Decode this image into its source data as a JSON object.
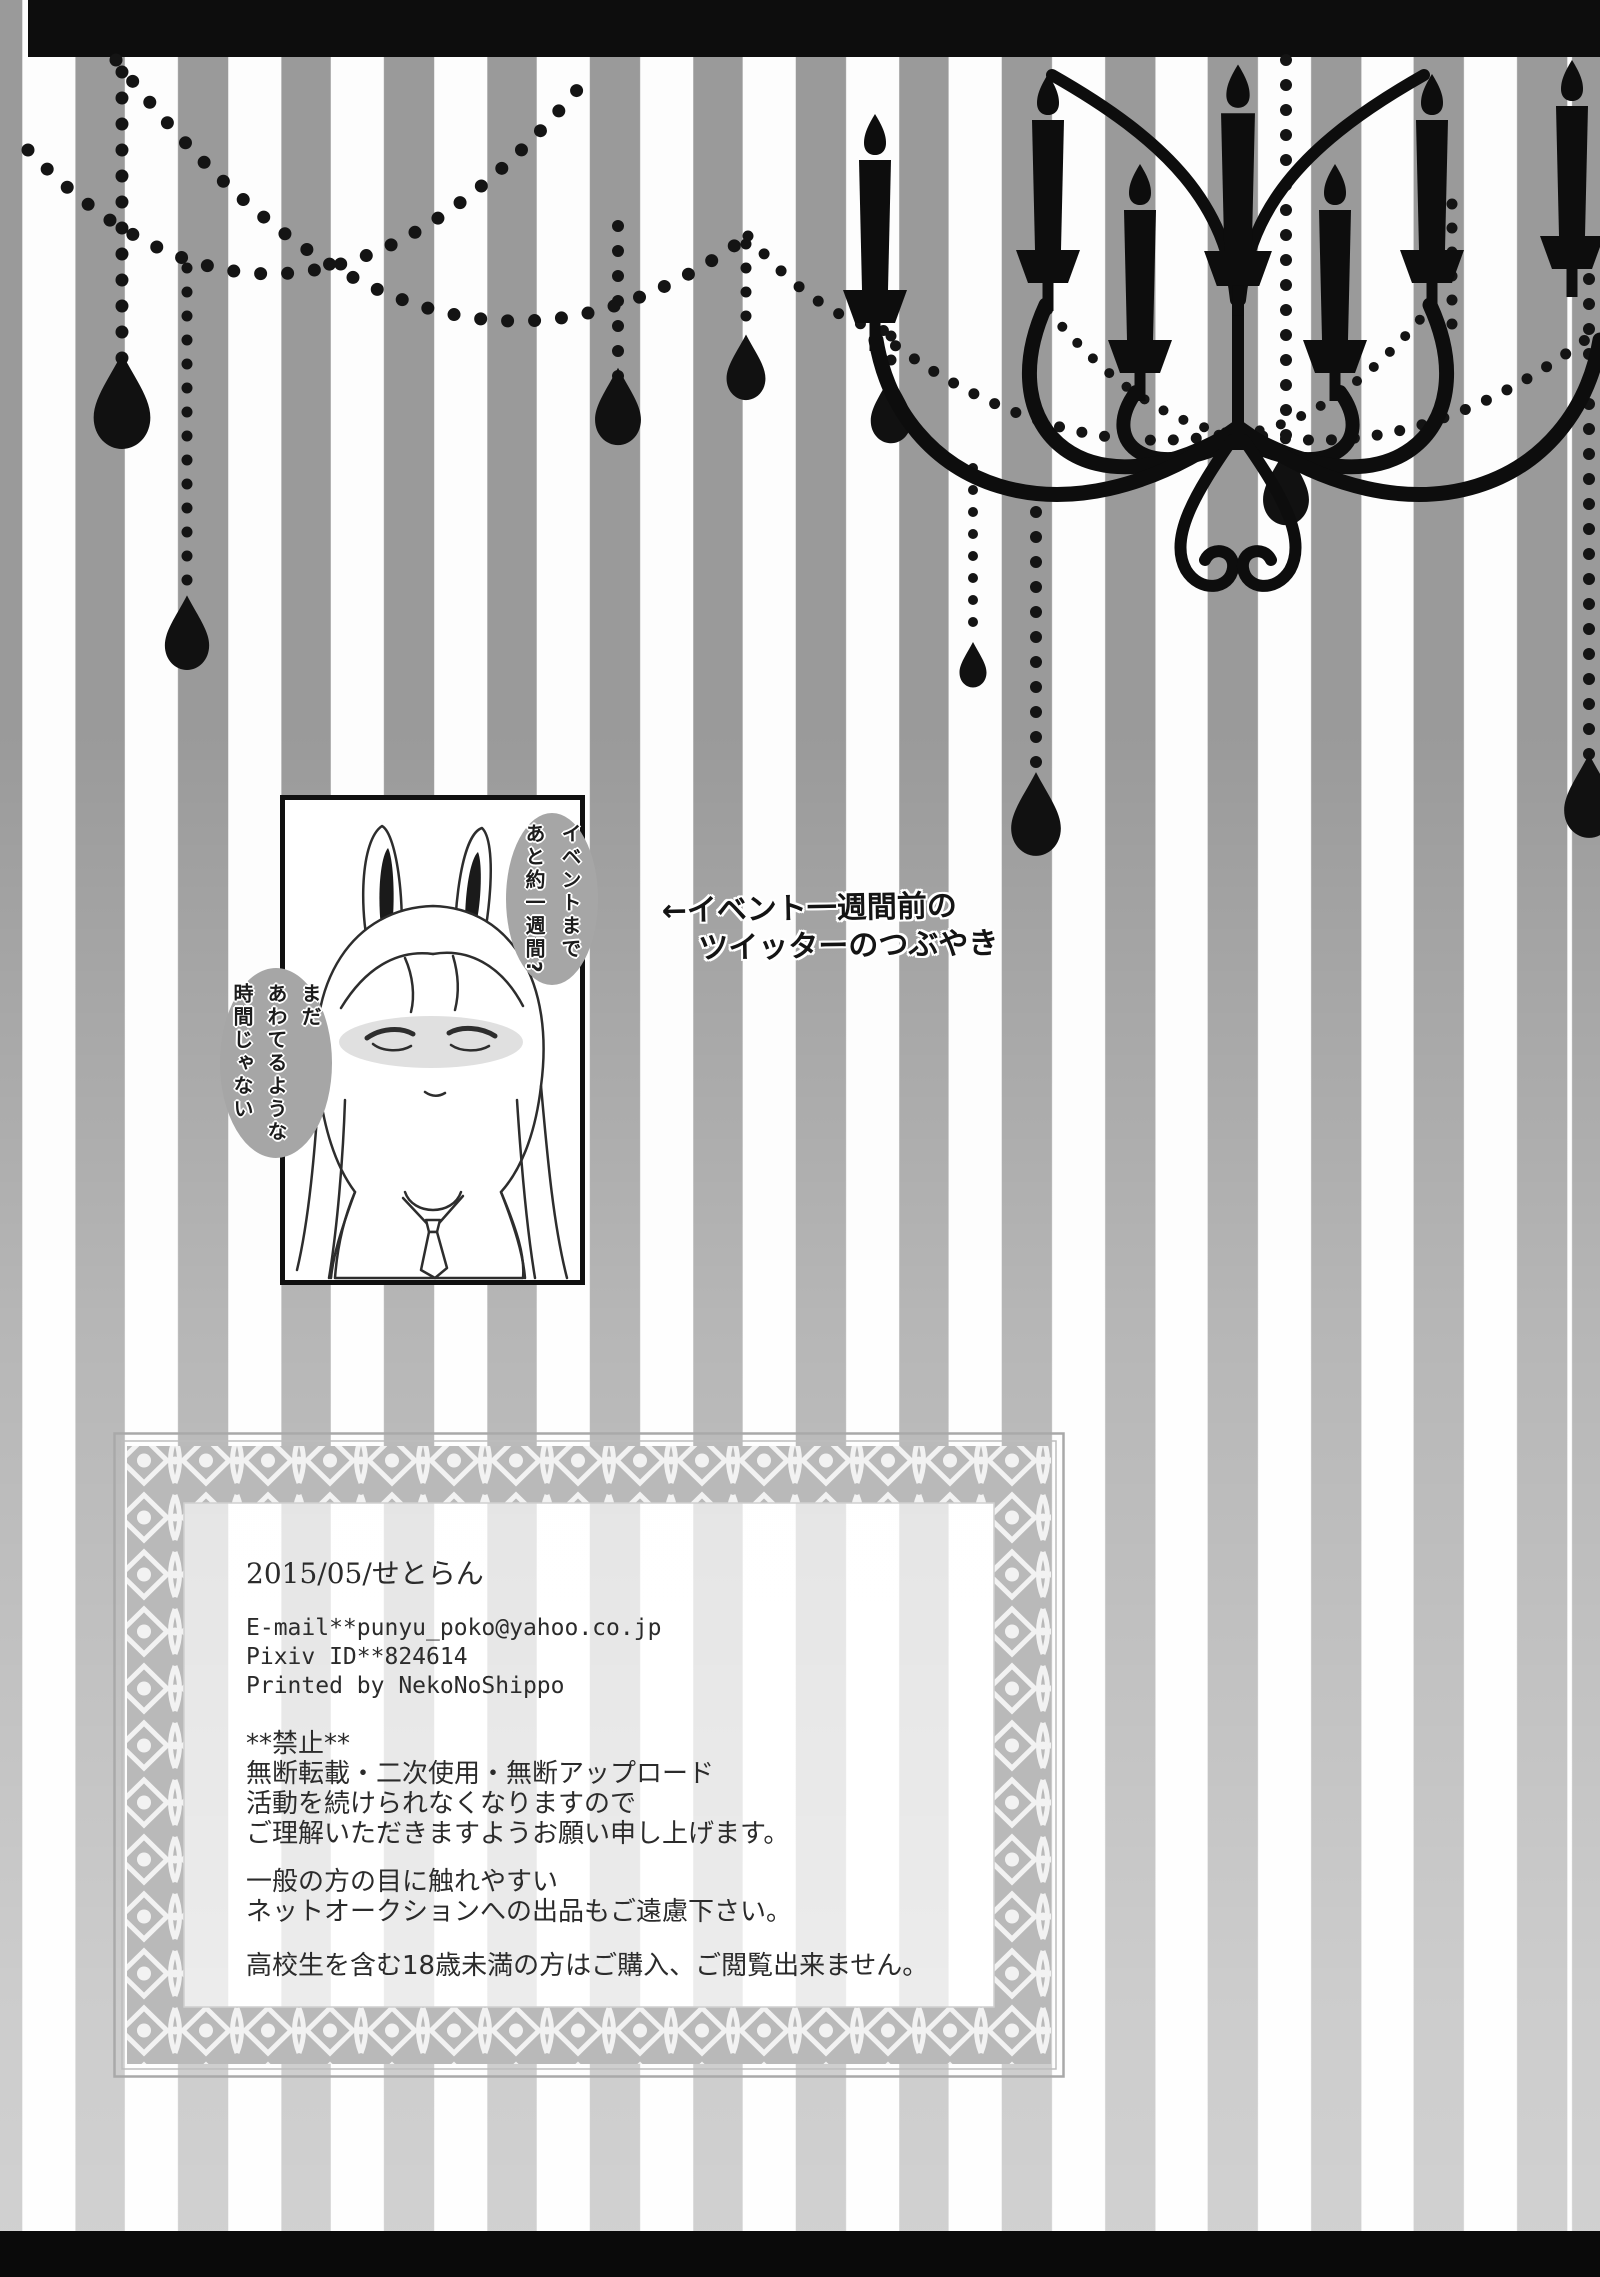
{
  "page_type": "doujinshi-afterword-page",
  "annotation": {
    "line1": "←イベント一週間前の",
    "line2": "ツイッターのつぶやき"
  },
  "illustration": {
    "description": "bunny-eared girl line art in black frame",
    "bubble_right": "イベントまで\nあと約一週間?",
    "bubble_left": "まだ\nあわてるような\n時間じゃない"
  },
  "credits": {
    "date_circle": "2015/05/せとらん",
    "email": "E-mail**punyu_poko@yahoo.co.jp",
    "pixiv": "Pixiv ID**824614",
    "printed": "Printed by NekoNoShippo",
    "ban_title": "**禁止**",
    "ban1": "無断転載・二次使用・無断アップロード",
    "ban2": "活動を続けられなくなりますので",
    "ban3": "ご理解いただきますようお願い申し上げます。",
    "auction1": "一般の方の目に触れやすい",
    "auction2": "ネットオークションへの出品もご遠慮下さい。",
    "age_notice": "高校生を含む18歳未満の方はご購入、ご閲覧出来ません。"
  },
  "colors": {
    "stripe_gray": "#9a9a9a",
    "stripe_white": "#fdfdfd",
    "silhouette_black": "#0d0d0d",
    "bubble_gray": "#a6a6a6",
    "ornate_band_gray": "#b9b9b9",
    "text_dark": "#2b2b2b"
  }
}
